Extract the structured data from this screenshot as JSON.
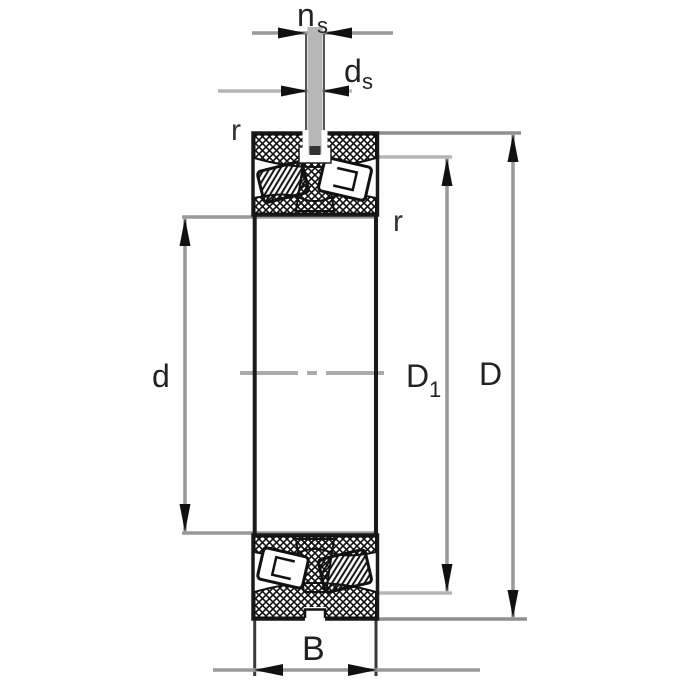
{
  "drawing": {
    "kind": "bearing-cross-section",
    "labels": {
      "groove_width": {
        "base": "n",
        "sub": "s"
      },
      "hole_diameter": {
        "base": "d",
        "sub": "s"
      },
      "outer_ring_chamfer": "r",
      "inner_ring_chamfer": "r",
      "bore_diameter": "d",
      "shoulder_diameter": {
        "base": "D",
        "sub": "1"
      },
      "outside_diameter": "D",
      "width": "B"
    },
    "colors": {
      "outline": "#1a1a1a",
      "hatch": "#111111",
      "dimension_line": "#999999",
      "dimension_line_light": "#b5b5b5",
      "extension_line_dark": "#8f8f8f",
      "centerline": "#ababab",
      "arrowhead": "#111111",
      "pin_fill": "#b7b7b7",
      "label_text": "#222222",
      "background": "#ffffff"
    }
  }
}
